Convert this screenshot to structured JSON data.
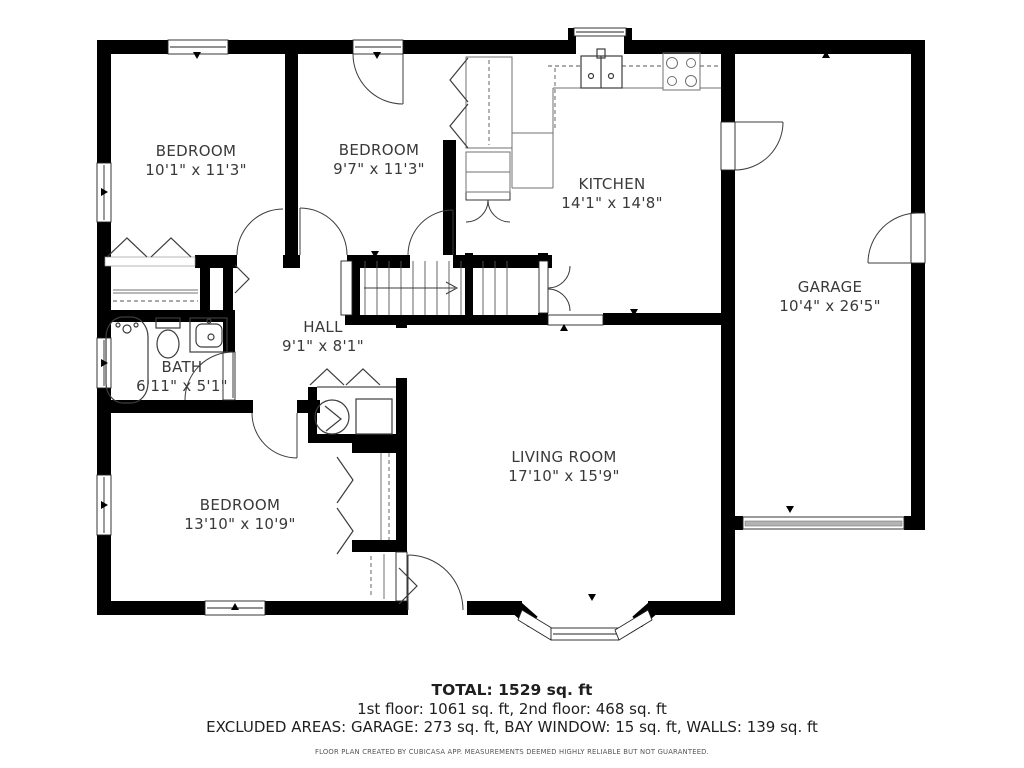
{
  "plan": {
    "rooms": [
      {
        "id": "bedroom-1",
        "name": "BEDROOM",
        "dims": "10'1\" x 11'3\""
      },
      {
        "id": "bedroom-2",
        "name": "BEDROOM",
        "dims": "9'7\" x 11'3\""
      },
      {
        "id": "kitchen",
        "name": "KITCHEN",
        "dims": "14'1\" x 14'8\""
      },
      {
        "id": "garage",
        "name": "GARAGE",
        "dims": "10'4\" x 26'5\""
      },
      {
        "id": "hall",
        "name": "HALL",
        "dims": "9'1\" x 8'1\""
      },
      {
        "id": "bath",
        "name": "BATH",
        "dims": "6'11\" x 5'1\""
      },
      {
        "id": "bedroom-3",
        "name": "BEDROOM",
        "dims": "13'10\" x 10'9\""
      },
      {
        "id": "living-room",
        "name": "LIVING ROOM",
        "dims": "17'10\" x 15'9\""
      }
    ],
    "colors": {
      "wall": "#000000",
      "garage_door": "#b3b3b3",
      "label_text": "#3a3a3a"
    }
  },
  "footer": {
    "total": "TOTAL: 1529 sq. ft",
    "floors": "1st floor: 1061 sq. ft, 2nd floor: 468 sq. ft",
    "excluded": "EXCLUDED AREAS: GARAGE: 273 sq. ft, BAY WINDOW: 15 sq. ft, WALLS: 139 sq. ft",
    "disclaimer": "FLOOR PLAN CREATED BY CUBICASA APP. MEASUREMENTS DEEMED HIGHLY RELIABLE BUT NOT GUARANTEED."
  }
}
